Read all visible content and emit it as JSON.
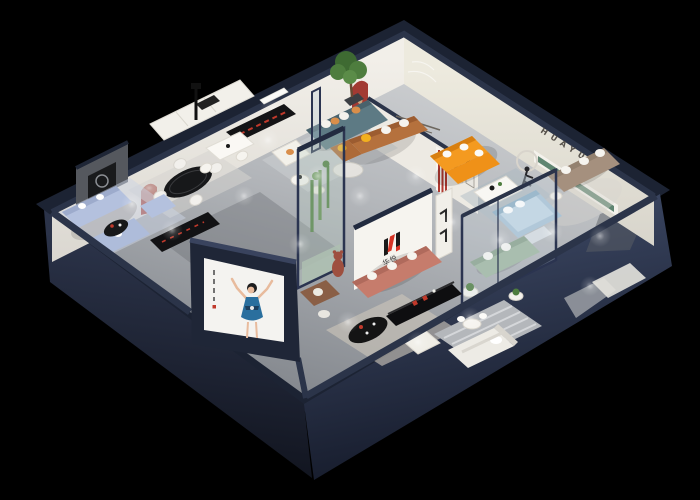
{
  "scene": {
    "description": "3D isometric cutaway render of a HUAYUE furniture showroom floor plan on a black background",
    "view": "isometric dollhouse cutaway",
    "background": "#000000"
  },
  "brand": {
    "mark": "H",
    "name_cn": "华悦",
    "lettering": "HUAYUE",
    "logo_red": "#d63426",
    "logo_black": "#1a1a1a"
  },
  "palette": {
    "background": "#000000",
    "wall_cap_navy": "#2b3449",
    "exterior_wall_navy": "#242c40",
    "interior_wall_cream": "#efece5",
    "floor_gray": "#b4b7bb",
    "accent_red_niche": "#a23a33",
    "orange_sofa": "#f49a20",
    "caramel_sofa": "#b5713d",
    "salmon_sofa": "#c67c6c",
    "periwinkle_sofa": "#b4c1de",
    "teal_sofa": "#5d7a84",
    "sage_sofa": "#9fb6a0",
    "taupe_sofa": "#a5907e",
    "blue_bed": "#a9c3d6",
    "green_shelf": "#5f8571",
    "poster_dress_blue": "#2a6f9e",
    "pillow_yellow": "#f2b01f"
  },
  "rooms": [
    {
      "name": "office-display",
      "furniture": [
        "white cabinet row",
        "black media console with red accent",
        "white meeting table",
        "two white chairs",
        "black floor lamp"
      ]
    },
    {
      "name": "lounge",
      "furniture": [
        "teal fabric sofa with white and orange pillows",
        "potted tree",
        "white armchair",
        "round white coffee tables",
        "glass divider"
      ]
    },
    {
      "name": "caramel-leather-zone",
      "furniture": [
        "caramel leather L-sofa",
        "yellow pillows",
        "oval glass coffee table",
        "red arch niche",
        "small wall tagline"
      ]
    },
    {
      "name": "orange-zone",
      "furniture": [
        "bright orange sectional sofa",
        "white coffee table",
        "art frames",
        "red striped column",
        "runner sculpture with ring"
      ]
    },
    {
      "name": "right-gallery",
      "furniture": [
        "HUAYUE wall lettering",
        "green recessed display shelf",
        "taupe sofa with white pillows"
      ]
    },
    {
      "name": "dining",
      "furniture": [
        "black oval dining table",
        "four white chairs",
        "red arch niche",
        "gray media wall with fireplace insert"
      ]
    },
    {
      "name": "periwinkle-lounge",
      "furniture": [
        "periwinkle sofa set",
        "black coffee table",
        "long black media console"
      ]
    },
    {
      "name": "brand-wall-zone",
      "furniture": [
        "white brand wall with H logo",
        "salmon sofa with white pillows",
        "bear mascot figure",
        "white display stand"
      ]
    },
    {
      "name": "center-vitrine",
      "furniture": [
        "glass plant vitrine with cacti"
      ]
    },
    {
      "name": "glass-bedroom",
      "furniture": [
        "light blue bed",
        "sage green sofa",
        "plant side tables",
        "glass walls with navy frame"
      ]
    },
    {
      "name": "bottom-living",
      "furniture": [
        "beige rug",
        "black oval coffee table",
        "white ottoman",
        "black media console with red books"
      ]
    },
    {
      "name": "bottom-bedroom",
      "furniture": [
        "white bed",
        "striped gray rug",
        "small white dining table"
      ]
    }
  ],
  "poster": {
    "subject": "dancing woman in blue dress",
    "panel_color": "#f4f3f0",
    "dress_color": "#2a6f9e",
    "location": "outside face of front-left navy wall"
  }
}
